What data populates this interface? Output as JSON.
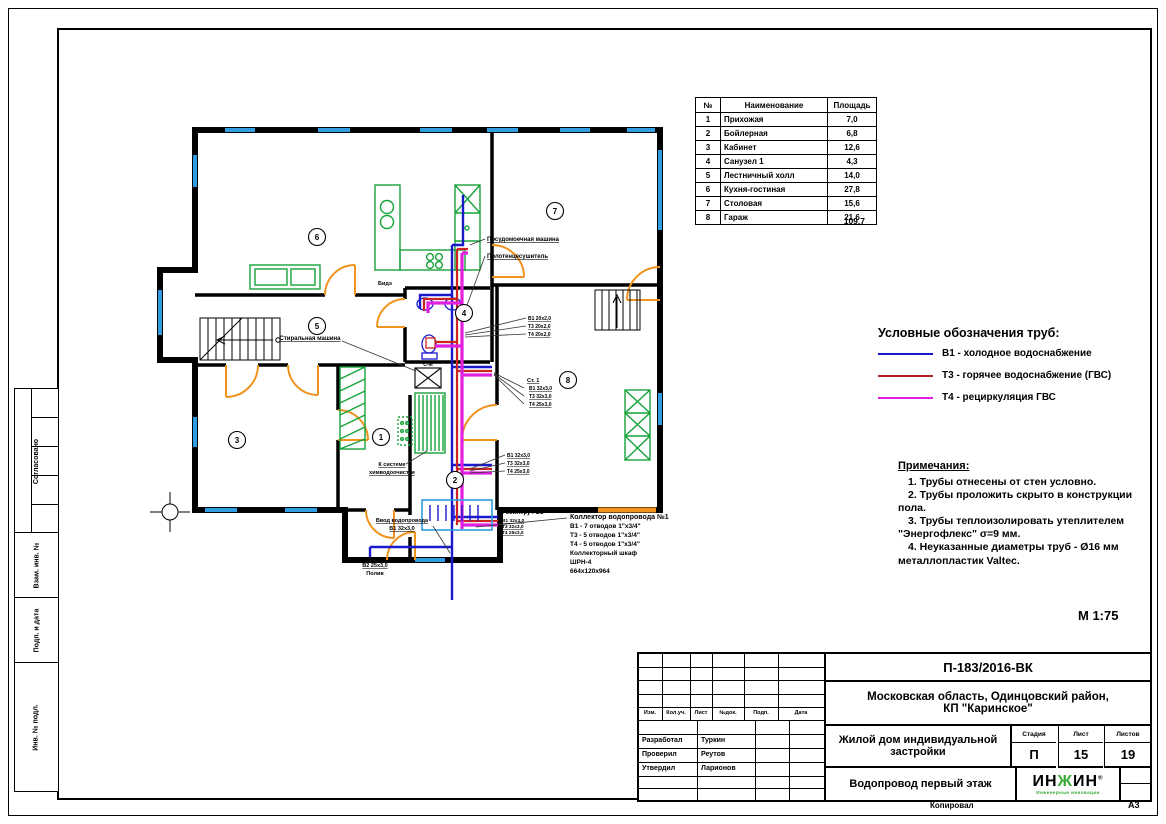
{
  "sheet": {
    "scale": "М 1:75",
    "format": "А3",
    "copied_by": "Копировал"
  },
  "colors": {
    "cold": "#1a1acc",
    "hot": "#b22222",
    "recirc": "#e020e0",
    "window": "#2f9de0",
    "door": "#f0931e",
    "furniture": "#16a33a",
    "logo_green": "#3aaa35"
  },
  "left_margin": {
    "stamps": [
      "Согласовано",
      "Взам. инв. №",
      "Подп. и дата",
      "Инв. № подл."
    ]
  },
  "room_table": {
    "headers": [
      "№",
      "Наименование",
      "Площадь"
    ],
    "rows": [
      [
        "1",
        "Прихожая",
        "7,0"
      ],
      [
        "2",
        "Бойлерная",
        "6,8"
      ],
      [
        "3",
        "Кабинет",
        "12,6"
      ],
      [
        "4",
        "Санузел 1",
        "4,3"
      ],
      [
        "5",
        "Лестничный холл",
        "14,0"
      ],
      [
        "6",
        "Кухня-гостиная",
        "27,8"
      ],
      [
        "7",
        "Столовая",
        "15,6"
      ],
      [
        "8",
        "Гараж",
        "21,6"
      ]
    ],
    "total": "109,7"
  },
  "legend": {
    "title": "Условные обозначения  труб:",
    "items": [
      {
        "label": "В1 - холодное водоснабжение",
        "color": "#1a1acc"
      },
      {
        "label": "Т3 - горячее водоснабжение (ГВС)",
        "color": "#b22222"
      },
      {
        "label": "Т4 - рециркуляция ГВС",
        "color": "#e020e0"
      }
    ]
  },
  "notes": {
    "title": "Примечания:",
    "lines": [
      "1. Трубы отнесены от стен условно.",
      "2. Трубы проложить скрыто в конструкции пола.",
      "3. Трубы теплоизолировать утеплителем \"Энергофлекс\" σ=9 мм.",
      "4. Неуказанные диаметры труб - Ø16 мм металлопластик Valtec."
    ]
  },
  "plan": {
    "rooms": [
      "1",
      "2",
      "3",
      "4",
      "5",
      "6",
      "7",
      "8"
    ],
    "labels": {
      "dishwasher": "Посудомоечная машина",
      "towel_dryer": "Полотенцесушитель",
      "bide": "Бидэ",
      "washing_machine": "Стиральная машина",
      "sm": "С-М",
      "chem1": "К системе",
      "chem2": "химводоочистки",
      "inlet1": "Ввод водопровода",
      "inlet2": "В1 32х3,0",
      "irrigation1": "В2 25х3,0",
      "irrigation2": "Полив",
      "boiler": "К бойлеру ГВС",
      "boiler_b1": "В1 32х3,0",
      "boiler_t3": "Т3 32х3,0",
      "boiler_t4": "Т4 25х3,0",
      "up_b1": "В1 20х2,0",
      "up_t3": "Т3 20х2,0",
      "up_t4": "Т4 20х2,0",
      "st1": "Ст. 1",
      "st_b1": "В1 32х3,0",
      "st_t3": "Т3 32х3,0",
      "st_t4": "Т4 25х3,0",
      "low_b1": "В1 32х3,0",
      "low_t3": "Т3 32х3,0",
      "low_t4": "Т4 25х3,0",
      "col1": "Коллектор водопровода №1",
      "col2": "В1 - 7 отводов 1\"х3/4\"",
      "col3": "Т3 - 5 отводов 1\"х3/4\"",
      "col4": "Т4 - 5 отводов 1\"х3/4\"",
      "col5": "Коллекторный шкаф",
      "col6": "ШРН-4",
      "col7": "664х120х964"
    }
  },
  "title_block": {
    "doc_number": "П-183/2016-ВК",
    "location1": "Московская область, Одинцовский район,",
    "location2": "КП \"Каринское\"",
    "object1": "Жилой дом индивидуальной",
    "object2": "застройки",
    "drawing_title": "Водопровод первый этаж",
    "stage_label": "Стадия",
    "sheet_label": "Лист",
    "sheets_label": "Листов",
    "stage": "П",
    "sheet": "15",
    "sheets": "19",
    "columns": [
      "Изм.",
      "Кол.уч.",
      "Лист",
      "№док.",
      "Подп.",
      "Дата"
    ],
    "roles": [
      [
        "Разработал",
        "Туркин"
      ],
      [
        "Проверил",
        "Реутов"
      ],
      [
        "Утвердил",
        "Ларионов"
      ]
    ],
    "logo": {
      "part1": "ИН",
      "part2": "Ж",
      "part3": "ИН",
      "reg": "®",
      "tagline": "Инженерные инновации"
    }
  }
}
